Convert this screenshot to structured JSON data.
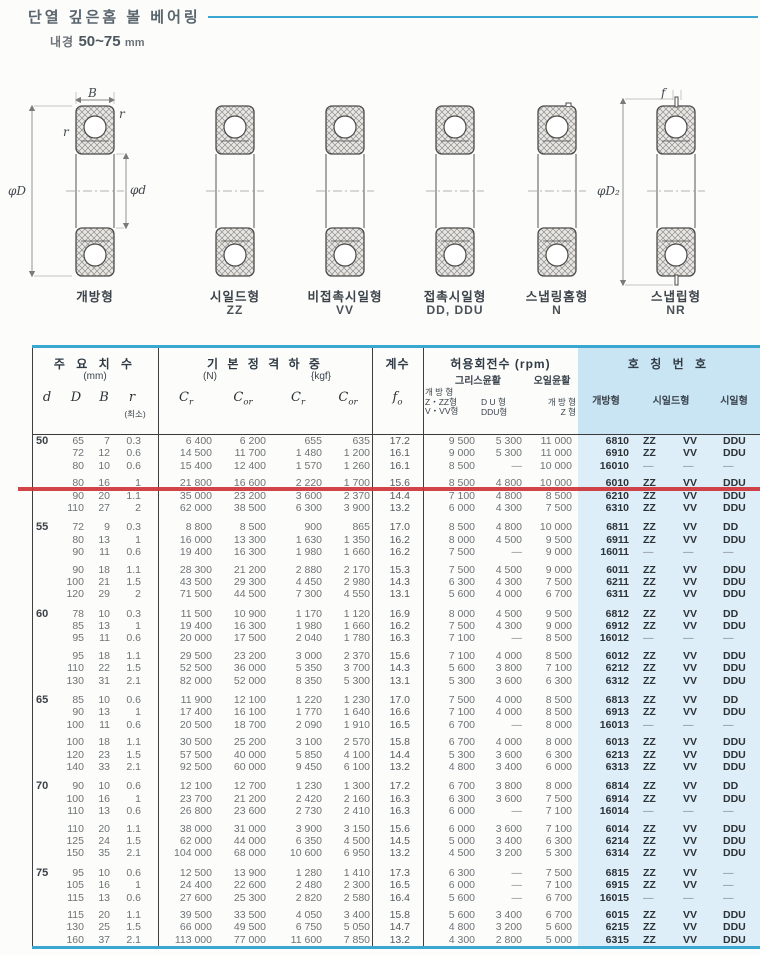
{
  "page": {
    "title": "단열 깊은홈 볼 베어링",
    "bore_label": "내경",
    "bore_range": "50~75",
    "bore_unit": "mm"
  },
  "colors": {
    "accent_cyan": "#3aa7d1",
    "panel_blue_header": "#c9e4f2",
    "panel_blue_body": "#ddeef8",
    "marker_red": "#cd3438"
  },
  "diagrams": {
    "dims": {
      "b": "B",
      "r": "r",
      "phi_d_outer": "φD",
      "phi_d_inner": "φd",
      "f": "f",
      "phi_d2": "φD₂"
    },
    "types": [
      {
        "label": "개방형",
        "code": ""
      },
      {
        "label": "시일드형",
        "code": "ZZ"
      },
      {
        "label": "비접촉시일형",
        "code": "VV"
      },
      {
        "label": "접촉시일형",
        "code": "DD, DDU"
      },
      {
        "label": "스냅링홈형",
        "code": "N"
      },
      {
        "label": "스냅립형",
        "code": "NR"
      }
    ]
  },
  "table": {
    "header": {
      "dims_title": "주 요 치 수",
      "dims_unit": "(mm)",
      "col_d": "d",
      "col_D": "D",
      "col_B": "B",
      "col_r": "r",
      "col_r_note": "(최소)",
      "load_title": "기 본 정 격 하 중",
      "load_unit_n": "(N)",
      "load_unit_kgf": "{kgf}",
      "c": "C",
      "sub_r": "r",
      "sub_or": "or",
      "factor_title": "계수",
      "f": "f",
      "sub_o": "o",
      "speed_title": "허용회전수 (rpm)",
      "grease": "그리스윤활",
      "oil": "오일윤활",
      "speed_col1": "개 방 형\nZ・ZZ형\nV・VV형",
      "speed_col2": "D U 형\nDDU형",
      "speed_col3": "개 방 형\nZ 형",
      "number_title": "호 칭 번 호",
      "number_col1": "개방형",
      "number_col2": "시일드형",
      "number_col3": "시일형"
    },
    "groups": [
      {
        "d": "50",
        "rows": [
          [
            "65",
            "7",
            "0.3",
            "6 400",
            "6 200",
            "655",
            "635",
            "17.2",
            "9 500",
            "5 300",
            "11 000",
            "6810",
            "ZZ",
            "VV",
            "DDU"
          ],
          [
            "72",
            "12",
            "0.6",
            "14 500",
            "11 700",
            "1 480",
            "1 200",
            "16.1",
            "9 000",
            "5 300",
            "11 000",
            "6910",
            "ZZ",
            "VV",
            "DDU"
          ],
          [
            "80",
            "10",
            "0.6",
            "15 400",
            "12 400",
            "1 570",
            "1 260",
            "16.1",
            "8 500",
            "—",
            "10 000",
            "16010",
            "—",
            "—",
            "—"
          ],
          [
            "80",
            "16",
            "1",
            "21 800",
            "16 600",
            "2 220",
            "1 700",
            "15.6",
            "8 500",
            "4 800",
            "10 000",
            "6010",
            "ZZ",
            "VV",
            "DDU"
          ],
          [
            "90",
            "20",
            "1.1",
            "35 000",
            "23 200",
            "3 600",
            "2 370",
            "14.4",
            "7 100",
            "4 800",
            "8 500",
            "6210",
            "ZZ",
            "VV",
            "DDU"
          ],
          [
            "110",
            "27",
            "2",
            "62 000",
            "38 500",
            "6 300",
            "3 900",
            "13.2",
            "6 000",
            "4 300",
            "7 500",
            "6310",
            "ZZ",
            "VV",
            "DDU"
          ]
        ]
      },
      {
        "d": "55",
        "rows": [
          [
            "72",
            "9",
            "0.3",
            "8 800",
            "8 500",
            "900",
            "865",
            "17.0",
            "8 500",
            "4 800",
            "10 000",
            "6811",
            "ZZ",
            "VV",
            "DD"
          ],
          [
            "80",
            "13",
            "1",
            "16 000",
            "13 300",
            "1 630",
            "1 350",
            "16.2",
            "8 000",
            "4 500",
            "9 500",
            "6911",
            "ZZ",
            "VV",
            "DDU"
          ],
          [
            "90",
            "11",
            "0.6",
            "19 400",
            "16 300",
            "1 980",
            "1 660",
            "16.2",
            "7 500",
            "—",
            "9 000",
            "16011",
            "—",
            "—",
            "—"
          ],
          [
            "90",
            "18",
            "1.1",
            "28 300",
            "21 200",
            "2 880",
            "2 170",
            "15.3",
            "7 500",
            "4 500",
            "9 000",
            "6011",
            "ZZ",
            "VV",
            "DDU"
          ],
          [
            "100",
            "21",
            "1.5",
            "43 500",
            "29 300",
            "4 450",
            "2 980",
            "14.3",
            "6 300",
            "4 300",
            "7 500",
            "6211",
            "ZZ",
            "VV",
            "DDU"
          ],
          [
            "120",
            "29",
            "2",
            "71 500",
            "44 500",
            "7 300",
            "4 550",
            "13.1",
            "5 600",
            "4 000",
            "6 700",
            "6311",
            "ZZ",
            "VV",
            "DDU"
          ]
        ]
      },
      {
        "d": "60",
        "rows": [
          [
            "78",
            "10",
            "0.3",
            "11 500",
            "10 900",
            "1 170",
            "1 120",
            "16.9",
            "8 000",
            "4 500",
            "9 500",
            "6812",
            "ZZ",
            "VV",
            "DD"
          ],
          [
            "85",
            "13",
            "1",
            "19 400",
            "16 300",
            "1 980",
            "1 660",
            "16.2",
            "7 500",
            "4 300",
            "9 000",
            "6912",
            "ZZ",
            "VV",
            "DDU"
          ],
          [
            "95",
            "11",
            "0.6",
            "20 000",
            "17 500",
            "2 040",
            "1 780",
            "16.3",
            "7 100",
            "—",
            "8 500",
            "16012",
            "—",
            "—",
            "—"
          ],
          [
            "95",
            "18",
            "1.1",
            "29 500",
            "23 200",
            "3 000",
            "2 370",
            "15.6",
            "7 100",
            "4 000",
            "8 500",
            "6012",
            "ZZ",
            "VV",
            "DDU"
          ],
          [
            "110",
            "22",
            "1.5",
            "52 500",
            "36 000",
            "5 350",
            "3 700",
            "14.3",
            "5 600",
            "3 800",
            "7 100",
            "6212",
            "ZZ",
            "VV",
            "DDU"
          ],
          [
            "130",
            "31",
            "2.1",
            "82 000",
            "52 000",
            "8 350",
            "5 300",
            "13.1",
            "5 300",
            "3 600",
            "6 300",
            "6312",
            "ZZ",
            "VV",
            "DDU"
          ]
        ]
      },
      {
        "d": "65",
        "rows": [
          [
            "85",
            "10",
            "0.6",
            "11 900",
            "12 100",
            "1 220",
            "1 230",
            "17.0",
            "7 500",
            "4 000",
            "8 500",
            "6813",
            "ZZ",
            "VV",
            "DD"
          ],
          [
            "90",
            "13",
            "1",
            "17 400",
            "16 100",
            "1 770",
            "1 640",
            "16.6",
            "7 100",
            "4 000",
            "8 500",
            "6913",
            "ZZ",
            "VV",
            "DDU"
          ],
          [
            "100",
            "11",
            "0.6",
            "20 500",
            "18 700",
            "2 090",
            "1 910",
            "16.5",
            "6 700",
            "—",
            "8 000",
            "16013",
            "—",
            "—",
            "—"
          ],
          [
            "100",
            "18",
            "1.1",
            "30 500",
            "25 200",
            "3 100",
            "2 570",
            "15.8",
            "6 700",
            "4 000",
            "8 000",
            "6013",
            "ZZ",
            "VV",
            "DDU"
          ],
          [
            "120",
            "23",
            "1.5",
            "57 500",
            "40 000",
            "5 850",
            "4 100",
            "14.4",
            "5 300",
            "3 600",
            "6 300",
            "6213",
            "ZZ",
            "VV",
            "DDU"
          ],
          [
            "140",
            "33",
            "2.1",
            "92 500",
            "60 000",
            "9 450",
            "6 100",
            "13.2",
            "4 800",
            "3 400",
            "6 000",
            "6313",
            "ZZ",
            "VV",
            "DDU"
          ]
        ]
      },
      {
        "d": "70",
        "rows": [
          [
            "90",
            "10",
            "0.6",
            "12 100",
            "12 700",
            "1 230",
            "1 300",
            "17.2",
            "6 700",
            "3 800",
            "8 000",
            "6814",
            "ZZ",
            "VV",
            "DD"
          ],
          [
            "100",
            "16",
            "1",
            "23 700",
            "21 200",
            "2 420",
            "2 160",
            "16.3",
            "6 300",
            "3 600",
            "7 500",
            "6914",
            "ZZ",
            "VV",
            "DDU"
          ],
          [
            "110",
            "13",
            "0.6",
            "26 800",
            "23 600",
            "2 730",
            "2 410",
            "16.3",
            "6 000",
            "—",
            "7 100",
            "16014",
            "—",
            "—",
            "—"
          ],
          [
            "110",
            "20",
            "1.1",
            "38 000",
            "31 000",
            "3 900",
            "3 150",
            "15.6",
            "6 000",
            "3 600",
            "7 100",
            "6014",
            "ZZ",
            "VV",
            "DDU"
          ],
          [
            "125",
            "24",
            "1.5",
            "62 000",
            "44 000",
            "6 350",
            "4 500",
            "14.5",
            "5 000",
            "3 400",
            "6 300",
            "6214",
            "ZZ",
            "VV",
            "DDU"
          ],
          [
            "150",
            "35",
            "2.1",
            "104 000",
            "68 000",
            "10 600",
            "6 950",
            "13.2",
            "4 500",
            "3 200",
            "5 300",
            "6314",
            "ZZ",
            "VV",
            "DDU"
          ]
        ]
      },
      {
        "d": "75",
        "rows": [
          [
            "95",
            "10",
            "0.6",
            "12 500",
            "13 900",
            "1 280",
            "1 410",
            "17.3",
            "6 300",
            "—",
            "7 500",
            "6815",
            "ZZ",
            "VV",
            "—"
          ],
          [
            "105",
            "16",
            "1",
            "24 400",
            "22 600",
            "2 480",
            "2 300",
            "16.5",
            "6 000",
            "—",
            "7 100",
            "6915",
            "ZZ",
            "VV",
            "—"
          ],
          [
            "115",
            "13",
            "0.6",
            "27 600",
            "25 300",
            "2 820",
            "2 580",
            "16.4",
            "5 600",
            "—",
            "6 700",
            "16015",
            "—",
            "—",
            "—"
          ],
          [
            "115",
            "20",
            "1.1",
            "39 500",
            "33 500",
            "4 050",
            "3 400",
            "15.8",
            "5 600",
            "3 400",
            "6 700",
            "6015",
            "ZZ",
            "VV",
            "DDU"
          ],
          [
            "130",
            "25",
            "1.5",
            "66 000",
            "49 500",
            "6 750",
            "5 050",
            "14.7",
            "4 800",
            "3 200",
            "5 600",
            "6215",
            "ZZ",
            "VV",
            "DDU"
          ],
          [
            "160",
            "37",
            "2.1",
            "113 000",
            "77 000",
            "11 600",
            "7 850",
            "13.2",
            "4 300",
            "2 800",
            "5 000",
            "6315",
            "ZZ",
            "VV",
            "DDU"
          ]
        ]
      }
    ]
  }
}
